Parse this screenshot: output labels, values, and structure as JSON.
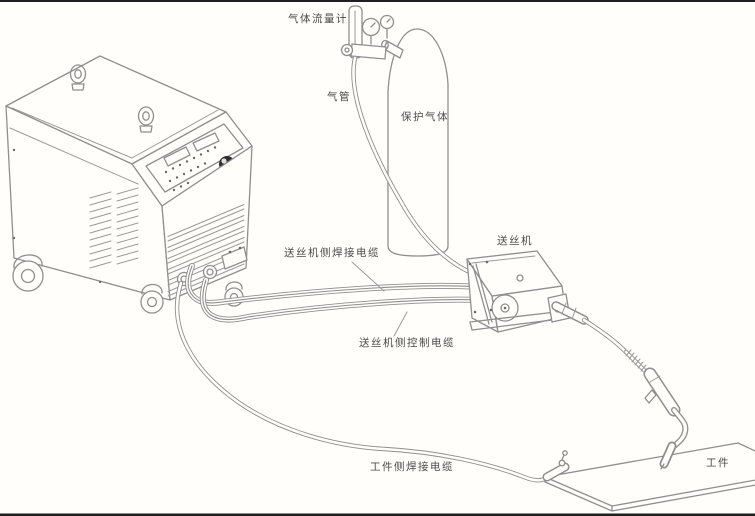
{
  "figure": {
    "type": "installation-wiring-diagram",
    "subject": "MIG/CO2 welding machine system connection",
    "canvas": {
      "width": 755,
      "height": 516
    }
  },
  "labels": {
    "gas_flowmeter": "气体流量计",
    "gas_hose": "气管",
    "shielding_gas": "保护气体",
    "wire_feeder": "送丝机",
    "feeder_side_welding_cable": "送丝机侧焊接电缆",
    "feeder_side_control_cable": "送丝机侧控制电缆",
    "workpiece_side_welding_cable": "工件侧焊接电缆",
    "workpiece": "工件"
  },
  "components": [
    "welding-power-source",
    "gas-flowmeter-regulator",
    "gas-cylinder",
    "gas-hose",
    "wire-feeder",
    "welding-torch",
    "workpiece-plate",
    "ground-clamp",
    "feeder-side-welding-cable",
    "feeder-side-control-cable",
    "workpiece-side-welding-cable"
  ],
  "colors": {
    "background": "#fffefa",
    "line_art": "#8f8f8f",
    "label_text": "#4b4b4b",
    "page_border": "#1f1f1f",
    "knob": "#2f2f2f"
  }
}
